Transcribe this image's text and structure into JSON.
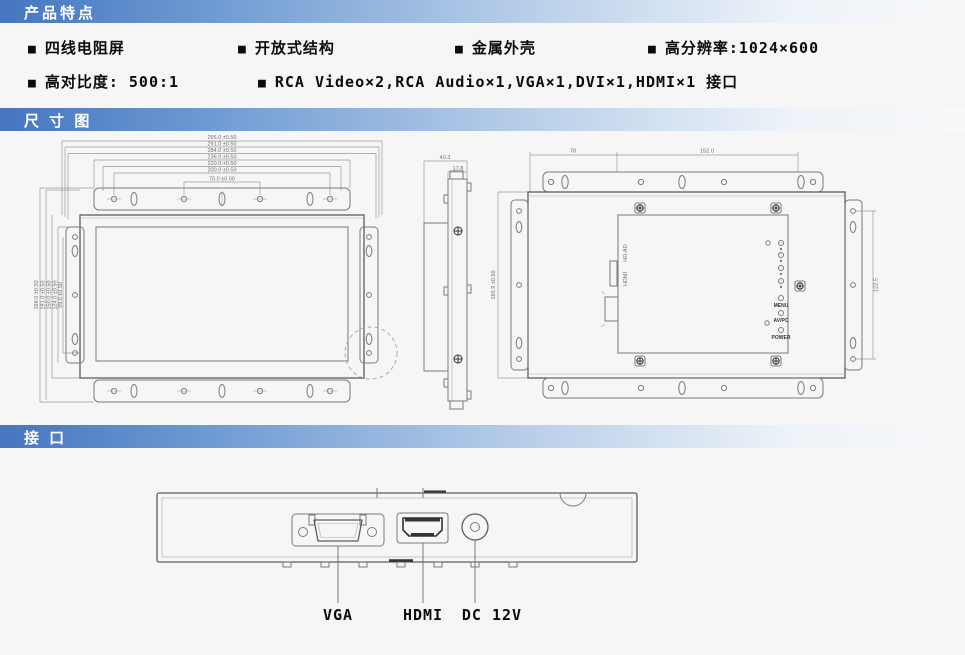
{
  "bullet": "■",
  "sections": {
    "features": "产品特点",
    "dimensions": "尺 寸 图",
    "interfaces": "接 口"
  },
  "features": {
    "row1": [
      "四线电阻屏",
      "开放式结构",
      "金属外壳",
      "高分辨率:1024×600"
    ],
    "row2": [
      "高对比度: 500:1",
      "RCA Video×2,RCA Audio×1,VGA×1,DVI×1,HDMI×1 接口"
    ]
  },
  "dimension_diagram": {
    "front_view": {
      "width_dims": [
        "296.0 ±0.50",
        "291.0 ±0.50",
        "284.0 ±0.50",
        "236.0 ±0.50",
        "220.0 ±0.50",
        "200.0 ±0.50",
        "70.0 ±0.50"
      ],
      "height_dims": [
        "198.0 ±0.50",
        "191.0 ±0.50",
        "150.0 ±0.50",
        "124.0 ±0.50",
        "99.0 ±0.50"
      ]
    },
    "side_view": {
      "depth_total": "40.3",
      "depth_front": "17.8"
    },
    "rear_view": {
      "top_dim_left": "78",
      "top_dim_right": "152.0",
      "height_dim": "185.9 ±0.50",
      "right_dim": "122.5",
      "port_labels": [
        "HD-AD",
        "HDMI"
      ],
      "button_labels": [
        "MENU",
        "AV/PC",
        "POWER"
      ]
    }
  },
  "interface_diagram": {
    "labels": [
      "VGA",
      "HDMI",
      "DC 12V"
    ]
  },
  "colors": {
    "header_gradient_start": "#4576bf",
    "header_gradient_end": "#f7f8f9",
    "line": "#7a7a7a",
    "dim_text": "#6f6f6f",
    "text": "#0b0b0b"
  }
}
